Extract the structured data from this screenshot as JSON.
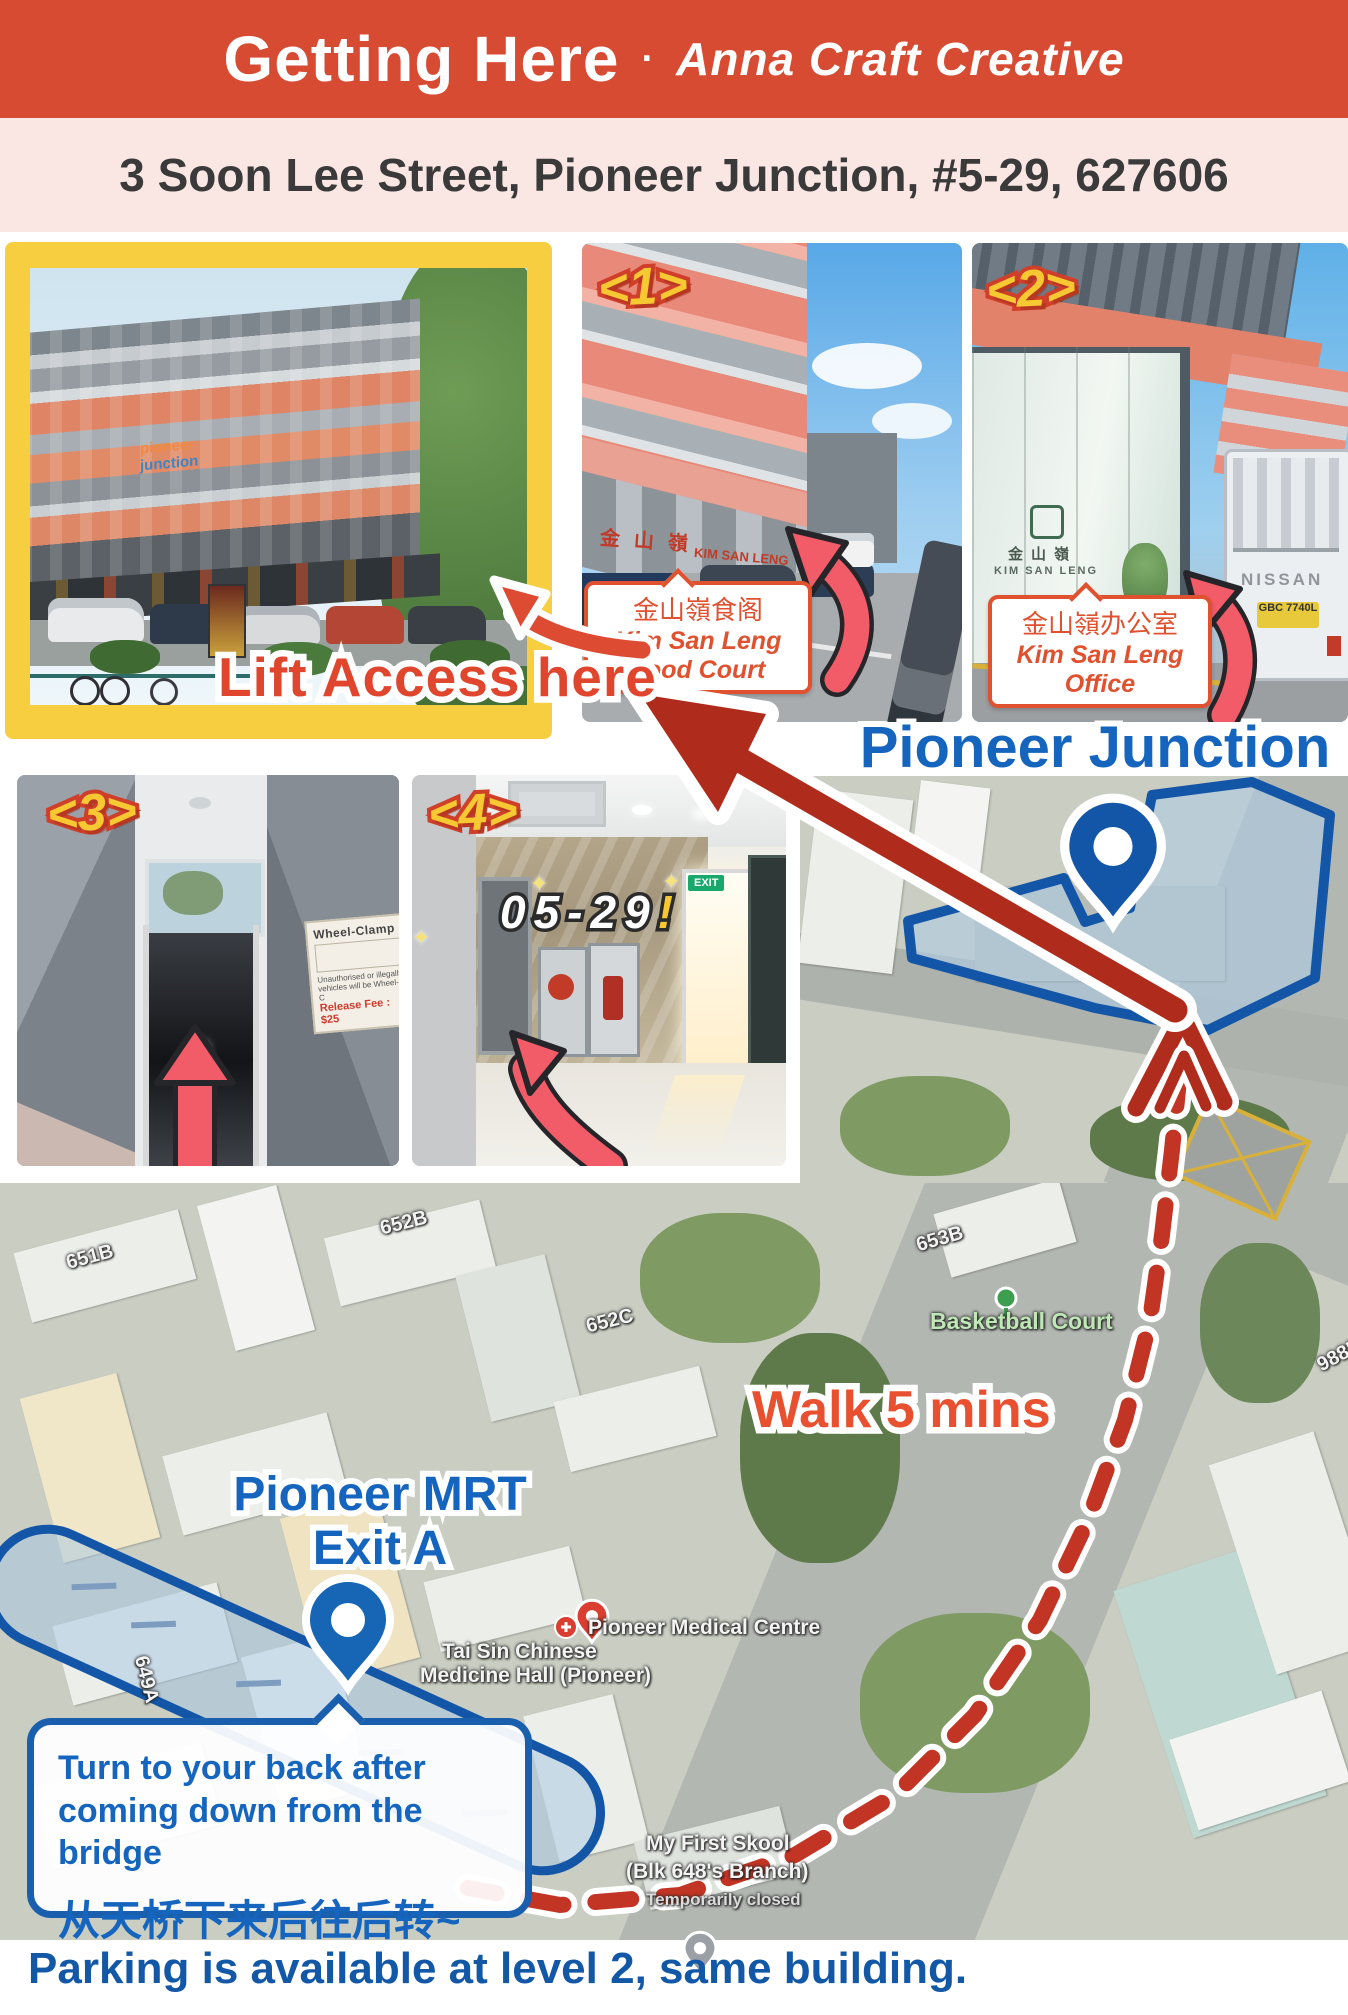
{
  "colors": {
    "header_red": "#d84b33",
    "address_pink": "#fae7e4",
    "frame_yellow": "#f6ce3f",
    "badge_yellow": "#f6c832",
    "badge_outline": "#cf3f2a",
    "label_orange": "#e0512f",
    "route_red": "#af2b1b",
    "dash_red": "#c23524",
    "arrow_pink": "#f25c68",
    "map_blue": "#1356a8",
    "text_blue": "#1565be",
    "footer_blue": "#1358a6"
  },
  "header": {
    "title": "Getting Here",
    "separator": "·",
    "brand": "Anna Craft Creative"
  },
  "address": {
    "text": "3 Soon Lee Street, Pioneer Junction, #5-29, 627606"
  },
  "photos": {
    "main": {
      "label": "Lift Access here",
      "sign_top": "pioneer",
      "sign_bottom": "junction"
    },
    "p1": {
      "badge": "<1>",
      "signage_zh": "金山嶺",
      "signage_en": "KIM SAN LENG",
      "caption_zh": "金山嶺食阁",
      "caption_en": "Kim San Leng Food Court"
    },
    "p2": {
      "badge": "<2>",
      "logo_zh": "金山嶺",
      "logo_en": "KIM SAN LENG",
      "truck_brand": "NISSAN",
      "truck_plate": "GBC 7740L",
      "caption_zh": "金山嶺办公室",
      "caption_en": "Kim San Leng Office"
    },
    "p3": {
      "badge": "<3>",
      "notice_title": "Wheel-Clamp",
      "notice_line1": "Unauthorised or illegally",
      "notice_line2": "vehicles will be Wheel-C",
      "notice_fee": "Release Fee : $25"
    },
    "p4": {
      "badge": "<4>",
      "unit_label": "05-29",
      "unit_bang": "!",
      "sparkle": "✦",
      "exit_sign": "EXIT"
    }
  },
  "map": {
    "building_label": "Pioneer Junction",
    "walk_label": "Walk 5 mins",
    "mrt_line1": "Pioneer MRT",
    "mrt_line2": "Exit A",
    "bubble": {
      "line1": "Turn to your back after",
      "line2": "coming down from the bridge",
      "line_zh": "从天桥下来后往后转~"
    },
    "labels": {
      "basketball": "Basketball Court",
      "taisin_line1": "Tai Sin Chinese",
      "taisin_line2": "Medicine Hall (Pioneer)",
      "medical": "Pioneer Medical Centre",
      "skool_line1": "My First Skool",
      "skool_line2": "(Blk 648's Branch)",
      "skool_line3": "Temporarily closed",
      "blk_651b": "651B",
      "blk_652b": "652B",
      "blk_652c": "652C",
      "blk_653b": "653B",
      "blk_649a": "649A",
      "blk_988b": "988B"
    }
  },
  "footer": {
    "note": "Parking is available at level 2, same building."
  }
}
